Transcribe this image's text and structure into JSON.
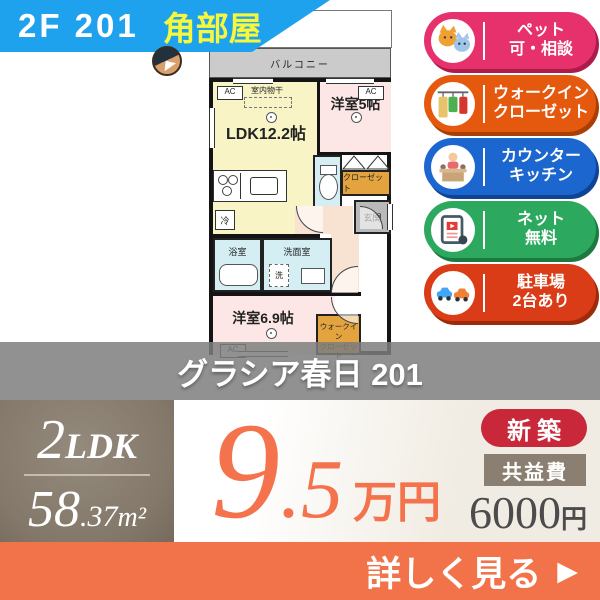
{
  "header": {
    "floor_room": "2F 201",
    "corner_label": "角部屋"
  },
  "floorplan": {
    "balcony": "バルコニー",
    "ac": "AC",
    "indoor_drying": "室内物干",
    "ldk": "LDK12.2帖",
    "bedroom1": "洋室5帖",
    "closet": "クローゼット",
    "entrance": "玄関",
    "fridge": "冷",
    "bath": "浴室",
    "washroom": "洗面室",
    "washer": "洗",
    "bedroom2": "洋室6.9帖",
    "wic_line1": "ウォークイン",
    "wic_line2": "クローゼット"
  },
  "badges": [
    {
      "name": "pets-allowed",
      "line1": "ペット",
      "line2": "可・相談",
      "color": "#e7316d",
      "shadow": "#ad1b4b",
      "icon": "pets-icon"
    },
    {
      "name": "walk-in-closet",
      "line1": "ウォークイン",
      "line2": "クローゼット",
      "color": "#e4590e",
      "shadow": "#aa3f06",
      "icon": "closet-icon"
    },
    {
      "name": "counter-kitchen",
      "line1": "カウンター",
      "line2": "キッチン",
      "color": "#1b66cf",
      "shadow": "#0f4494",
      "icon": "kitchen-icon"
    },
    {
      "name": "free-internet",
      "line1": "ネット",
      "line2": "無料",
      "color": "#2ca95e",
      "shadow": "#1c7a41",
      "icon": "internet-icon"
    },
    {
      "name": "parking-2cars",
      "line1": "駐車場",
      "line2": "2台あり",
      "color": "#d93c17",
      "shadow": "#9e2a0c",
      "icon": "cars-icon"
    }
  ],
  "property": {
    "name": "グラシア春日 201"
  },
  "unit": {
    "layout_number": "2",
    "layout_letters": "LDK",
    "area_int": "58",
    "area_dec": ".37",
    "area_unit": "m²"
  },
  "price": {
    "rent_int": "9",
    "rent_dec": ".5",
    "rent_unit": "万円"
  },
  "labels": {
    "new_construction": "新築",
    "common_fee_label": "共益費",
    "common_fee_value": "6000",
    "common_fee_unit": "円"
  },
  "cta": {
    "label": "詳しく見る",
    "arrow": "▶"
  },
  "colors": {
    "banner_blue": "#1fa2ee",
    "corner_yellow": "#f7f73c",
    "name_band_gray": "#7e7e7e",
    "unit_box_taupe": "#837869",
    "price_coral": "#f4724c",
    "new_badge_red": "#c9273a",
    "fee_box_taupe": "#8b7f71",
    "cta_orange": "#f2734a",
    "ldk_yellow": "#f8f4c6",
    "bedroom_pink": "#fce6e6",
    "wet_area_blue": "#d4eef3",
    "closet_orange": "#e3a43f",
    "balcony_gray": "#cbcbcb"
  }
}
